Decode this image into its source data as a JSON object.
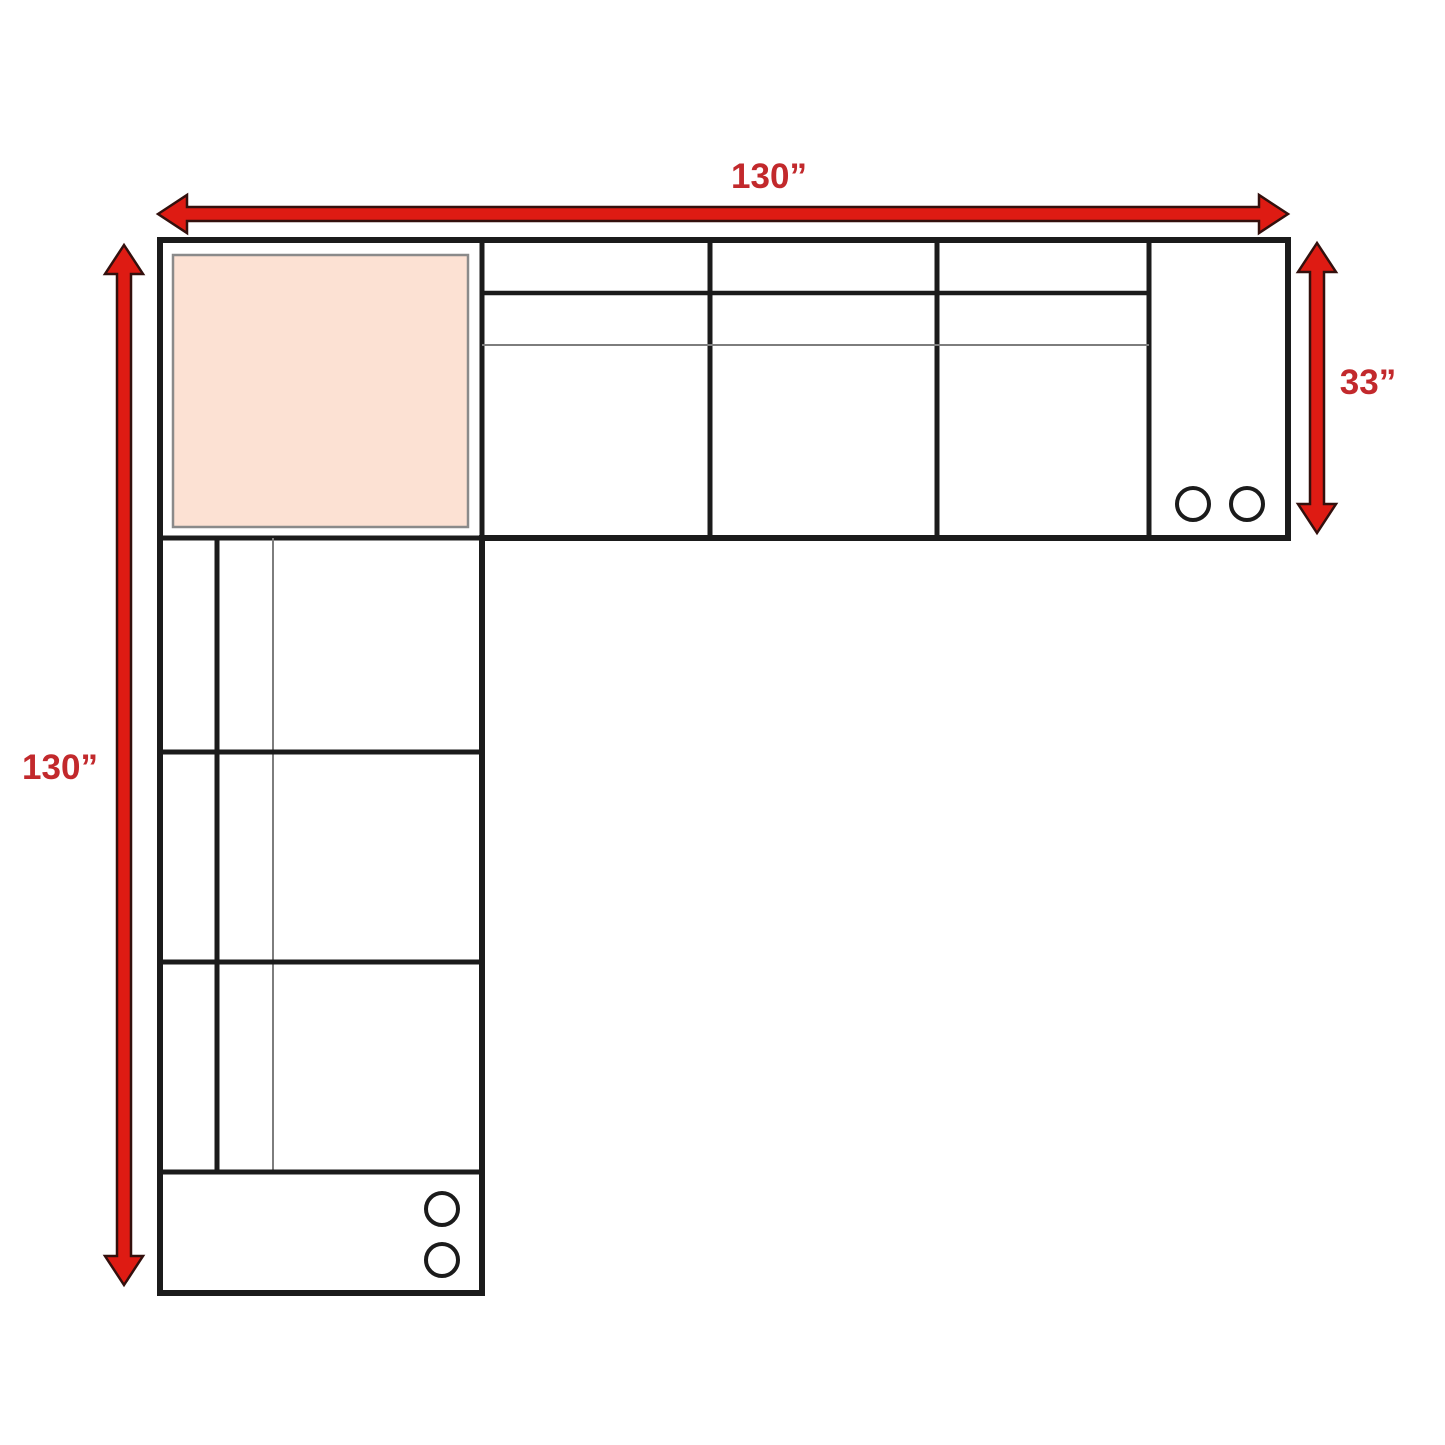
{
  "diagram": {
    "dimension_labels": {
      "top_width": "130”",
      "left_height": "130”",
      "right_depth": "33”"
    },
    "colors": {
      "arrow_red": "#DE1B13",
      "arrow_outline": "#33100D",
      "label_red": "#C2292C",
      "outline_black": "#1B1B1B",
      "detail_gray": "#7D7D7D",
      "cushion_border_gray": "#8A8A8A",
      "corner_cushion_fill": "#FCE1D3",
      "background": "#FFFFFF"
    }
  }
}
